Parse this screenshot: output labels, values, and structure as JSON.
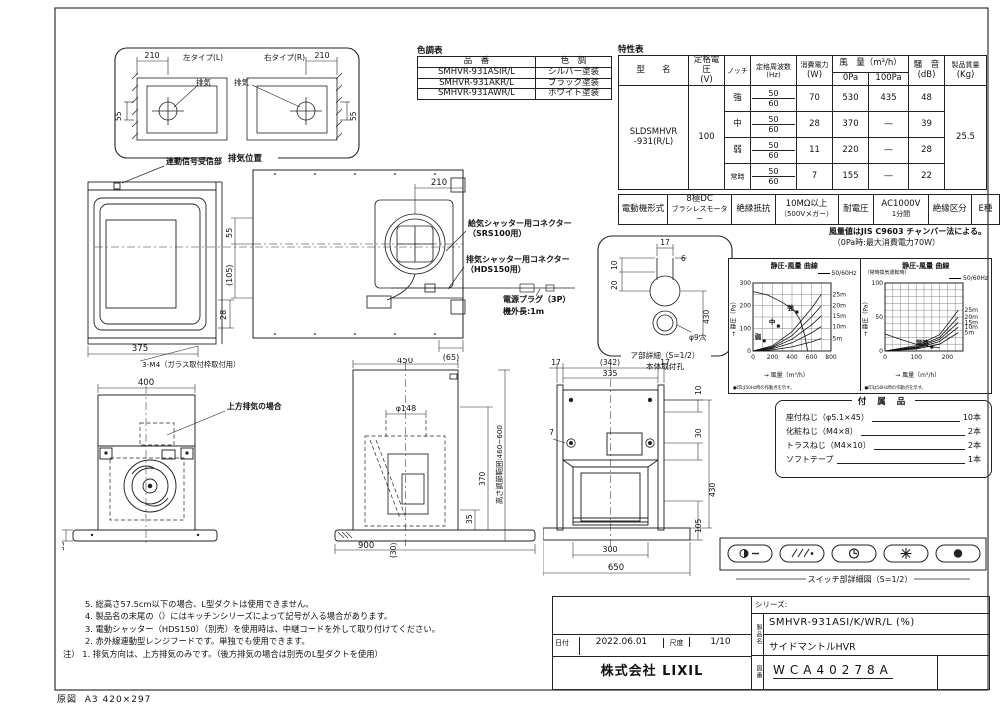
{
  "sheet": {
    "frame_label": "原図",
    "frame_size": "A3 420×297"
  },
  "exhaust_position": {
    "caption": "排気位置",
    "left_label": "左タイプ(L)",
    "right_label": "右タイプ(R)",
    "exhaust_left": "排気",
    "exhaust_right": "排気",
    "dim_210_left": "210",
    "dim_210_right": "210",
    "dim_55_left": "55",
    "dim_55_right": "55"
  },
  "color_table": {
    "title": "色調表",
    "col_part": "品　番",
    "col_color": "色　調",
    "rows": [
      {
        "part": "SMHVR-931ASIR/L",
        "color": "シルバー塗装"
      },
      {
        "part": "SMHVR-931AKR/L",
        "color": "ブラック塗装"
      },
      {
        "part": "SMHVR-931AWR/L",
        "color": "ホワイト塗装"
      }
    ]
  },
  "spec_table": {
    "title": "特性表",
    "h_model": "型　　名",
    "h_voltage1": "定格電圧",
    "h_voltage2": "(V)",
    "h_notch": "ノッチ",
    "h_freq1": "定格周波数",
    "h_freq2": "(Hz)",
    "h_power1": "消費電力",
    "h_power2": "(W)",
    "h_airflow": "風　量（m³/h）",
    "h_airflow_0": "0Pa",
    "h_airflow_100": "100Pa",
    "h_noise1": "騒　音",
    "h_noise2": "(dB)",
    "h_mass1": "製品質量",
    "h_mass2": "(Kg)",
    "model1": "SLDSMHVR",
    "model2": "-931(R/L)",
    "voltage": "100",
    "mass": "25.5",
    "rows": [
      {
        "notch": "強",
        "f1": "50",
        "f2": "60",
        "power": "70",
        "q0": "530",
        "q100": "435",
        "noise": "48"
      },
      {
        "notch": "中",
        "f1": "50",
        "f2": "60",
        "power": "28",
        "q0": "370",
        "q100": "―",
        "noise": "39"
      },
      {
        "notch": "弱",
        "f1": "50",
        "f2": "60",
        "power": "11",
        "q0": "220",
        "q100": "―",
        "noise": "28"
      },
      {
        "notch": "常時",
        "f1": "50",
        "f2": "60",
        "power": "7",
        "q0": "155",
        "q100": "―",
        "noise": "22"
      }
    ]
  },
  "motor_table": {
    "c1": "電動機形式",
    "c2a": "8極DC",
    "c2b": "ブラシレスモーター",
    "c3": "絶縁抵抗",
    "c4a": "10MΩ以上",
    "c4b": "（500Vメガー）",
    "c5": "耐電圧",
    "c6a": "AC1000V",
    "c6b": "1分間",
    "c7": "絶縁区分",
    "c8": "E種"
  },
  "airflow_note": {
    "line1": "風量値はJIS C9603 チャンバー法による。",
    "line2": "（0Pa時:最大消費電力70W）"
  },
  "side_view_top": {
    "receiver_label": "連動信号受信部",
    "dim_width": "375",
    "dim_height": "28",
    "screw_note": "3-M4（ガラス取付枠取付用）"
  },
  "plan_view": {
    "dim_210": "210",
    "dim_55": "55",
    "dim_105": "(105)",
    "dim_65": "(65)"
  },
  "connectors": {
    "supply1": "給気シャッター用コネクター",
    "supply2": "（SRS100用）",
    "exhaust1": "排気シャッター用コネクター",
    "exhaust2": "（HDS150用）",
    "plug": "電源プラグ（3P）",
    "cord": "機外長:1m"
  },
  "detail_a": {
    "dim_17": "17",
    "dim_6": "6",
    "dim_10": "10",
    "dim_20": "20",
    "dim_430": "430",
    "hole": "φ9穴",
    "caption": "ア部詳細（S=1/2）",
    "caption2": "本体取付孔"
  },
  "front_view_left": {
    "dim_400": "400",
    "top_exhaust": "上方排気の場合",
    "dim_35": "35"
  },
  "front_view_center": {
    "dim_450": "450",
    "dim_d148": "φ148",
    "range": "高さ調節範囲:460~600",
    "dim_370": "370",
    "dim_35": "35",
    "dim_30": "(30)",
    "dim_900": "900"
  },
  "rear_view": {
    "dim_17l": "17",
    "dim_342": "(342)",
    "dim_17r": "17",
    "dim_335": "335",
    "dim_10": "10",
    "dim_7": "7",
    "dim_30": "30",
    "dim_430": "430",
    "dim_105": "105",
    "dim_300": "300",
    "dim_650": "650"
  },
  "accessories": {
    "title": "付 属 品",
    "items": [
      {
        "name": "座付ねじ（φ5.1×45）",
        "qty": "10本"
      },
      {
        "name": "化粧ねじ（M4×8）",
        "qty": "2本"
      },
      {
        "name": "トラスねじ（M4×10）",
        "qty": "2本"
      },
      {
        "name": "ソフトテープ",
        "qty": "1本"
      }
    ]
  },
  "switch_panel": {
    "caption": "スイッチ部詳細図（S=1/2）",
    "buttons": [
      "power",
      "fan-speed",
      "timer",
      "light",
      "lamp"
    ]
  },
  "notes": {
    "lines": [
      "5. 総高さ57.5cm以下の場合、L型ダクトは使用できません。",
      "4. 製品名の末尾の（）にはキッチンシリーズによって記号が入る場合があります。",
      "3. 電動シャッター（HDS150）（別売）を使用時は、中継コードを外して取り付けてください。",
      "2. 赤外線連動型レンジフードです。単独でも使用できます。"
    ],
    "last": "注） 1. 排気方向は、上方排気のみです。（後方排気の場合は別売のL型ダクトを使用）"
  },
  "title_block": {
    "series_label": "シリーズ:",
    "name_label": "製品名",
    "product_code": "SMHVR-931ASI/K/WR/L (%)",
    "product_name": "サイドマントルHVR",
    "date_label": "日付",
    "date": "2022.06.01",
    "scale_label": "尺度",
    "scale": "1/10",
    "company": "株式会社 LIXIL",
    "dwg_label": "図番",
    "dwg_no": "WCA40278A"
  },
  "chart_data": [
    {
      "type": "line",
      "title": "静圧-風量 曲線",
      "subtitle": "",
      "legend": "50/60Hz",
      "xlabel": "→ 風量（m³/h）",
      "ylabel": "→ 静圧（Pa）",
      "xlim": [
        0,
        800
      ],
      "ylim": [
        0,
        300
      ],
      "xticks": [
        0,
        200,
        400,
        600,
        800
      ],
      "yticks": [
        0,
        100,
        200,
        300
      ],
      "xgrid": 100,
      "ygrid": 50,
      "grid": true,
      "legend_position": "top-right",
      "series": [
        {
          "name": "50/60Hz",
          "points": [
            [
              0,
              262
            ],
            [
              150,
              247
            ],
            [
              300,
              215
            ],
            [
              420,
              180
            ],
            [
              480,
              140
            ],
            [
              530,
              70
            ],
            [
              560,
              0
            ]
          ]
        },
        {
          "name": "5m",
          "points": [
            [
              0,
              0
            ],
            [
              200,
              5
            ],
            [
              400,
              18
            ],
            [
              600,
              40
            ],
            [
              700,
              55
            ]
          ]
        },
        {
          "name": "10m",
          "points": [
            [
              0,
              0
            ],
            [
              200,
              10
            ],
            [
              400,
              36
            ],
            [
              600,
              80
            ],
            [
              700,
              108
            ]
          ]
        },
        {
          "name": "15m",
          "points": [
            [
              0,
              0
            ],
            [
              200,
              14
            ],
            [
              400,
              52
            ],
            [
              600,
              115
            ],
            [
              700,
              155
            ]
          ]
        },
        {
          "name": "20m",
          "points": [
            [
              0,
              0
            ],
            [
              200,
              18
            ],
            [
              400,
              68
            ],
            [
              600,
              150
            ],
            [
              700,
              200
            ]
          ]
        },
        {
          "name": "25m",
          "points": [
            [
              0,
              0
            ],
            [
              200,
              23
            ],
            [
              400,
              85
            ],
            [
              600,
              188
            ],
            [
              700,
              250
            ]
          ]
        }
      ],
      "operating_points": [
        {
          "label": "強",
          "x": 450,
          "y": 172
        },
        {
          "label": "中",
          "x": 260,
          "y": 110
        },
        {
          "label": "弱",
          "x": 115,
          "y": 45
        }
      ],
      "footnote": "●印は50Hz時の作動点を示す。"
    },
    {
      "type": "line",
      "title": "静圧-風量 曲線",
      "subtitle": "（常時換気運転時）",
      "legend": "50/60Hz",
      "xlabel": "→ 風量（m³/h）",
      "ylabel": "→ 静圧（Pa）",
      "xlim": [
        0,
        250
      ],
      "ylim": [
        0,
        100
      ],
      "xticks": [
        0,
        100,
        200
      ],
      "yticks": [
        0,
        50,
        100
      ],
      "xgrid": 25,
      "ygrid": 10,
      "grid": true,
      "legend_position": "top-right",
      "series": [
        {
          "name": "50/60Hz",
          "points": [
            [
              0,
              25
            ],
            [
              50,
              17
            ],
            [
              100,
              10
            ],
            [
              150,
              6
            ],
            [
              175,
              5
            ]
          ]
        },
        {
          "name": "5m",
          "points": [
            [
              0,
              0
            ],
            [
              100,
              3
            ],
            [
              175,
              10
            ],
            [
              235,
              27
            ]
          ]
        },
        {
          "name": "10m",
          "points": [
            [
              0,
              0
            ],
            [
              100,
              4
            ],
            [
              175,
              14
            ],
            [
              235,
              35
            ]
          ]
        },
        {
          "name": "15m",
          "points": [
            [
              0,
              0
            ],
            [
              100,
              5
            ],
            [
              175,
              17
            ],
            [
              235,
              42
            ]
          ]
        },
        {
          "name": "20m",
          "points": [
            [
              0,
              0
            ],
            [
              100,
              6
            ],
            [
              175,
              20
            ],
            [
              235,
              50
            ]
          ]
        },
        {
          "name": "25m",
          "points": [
            [
              0,
              0
            ],
            [
              100,
              8
            ],
            [
              175,
              24
            ],
            [
              235,
              60
            ]
          ]
        }
      ],
      "operating_points": [
        {
          "label": "常時",
          "x": 150,
          "y": 6
        }
      ],
      "footnote": "●印は50Hz時の作動点を示す。"
    }
  ]
}
